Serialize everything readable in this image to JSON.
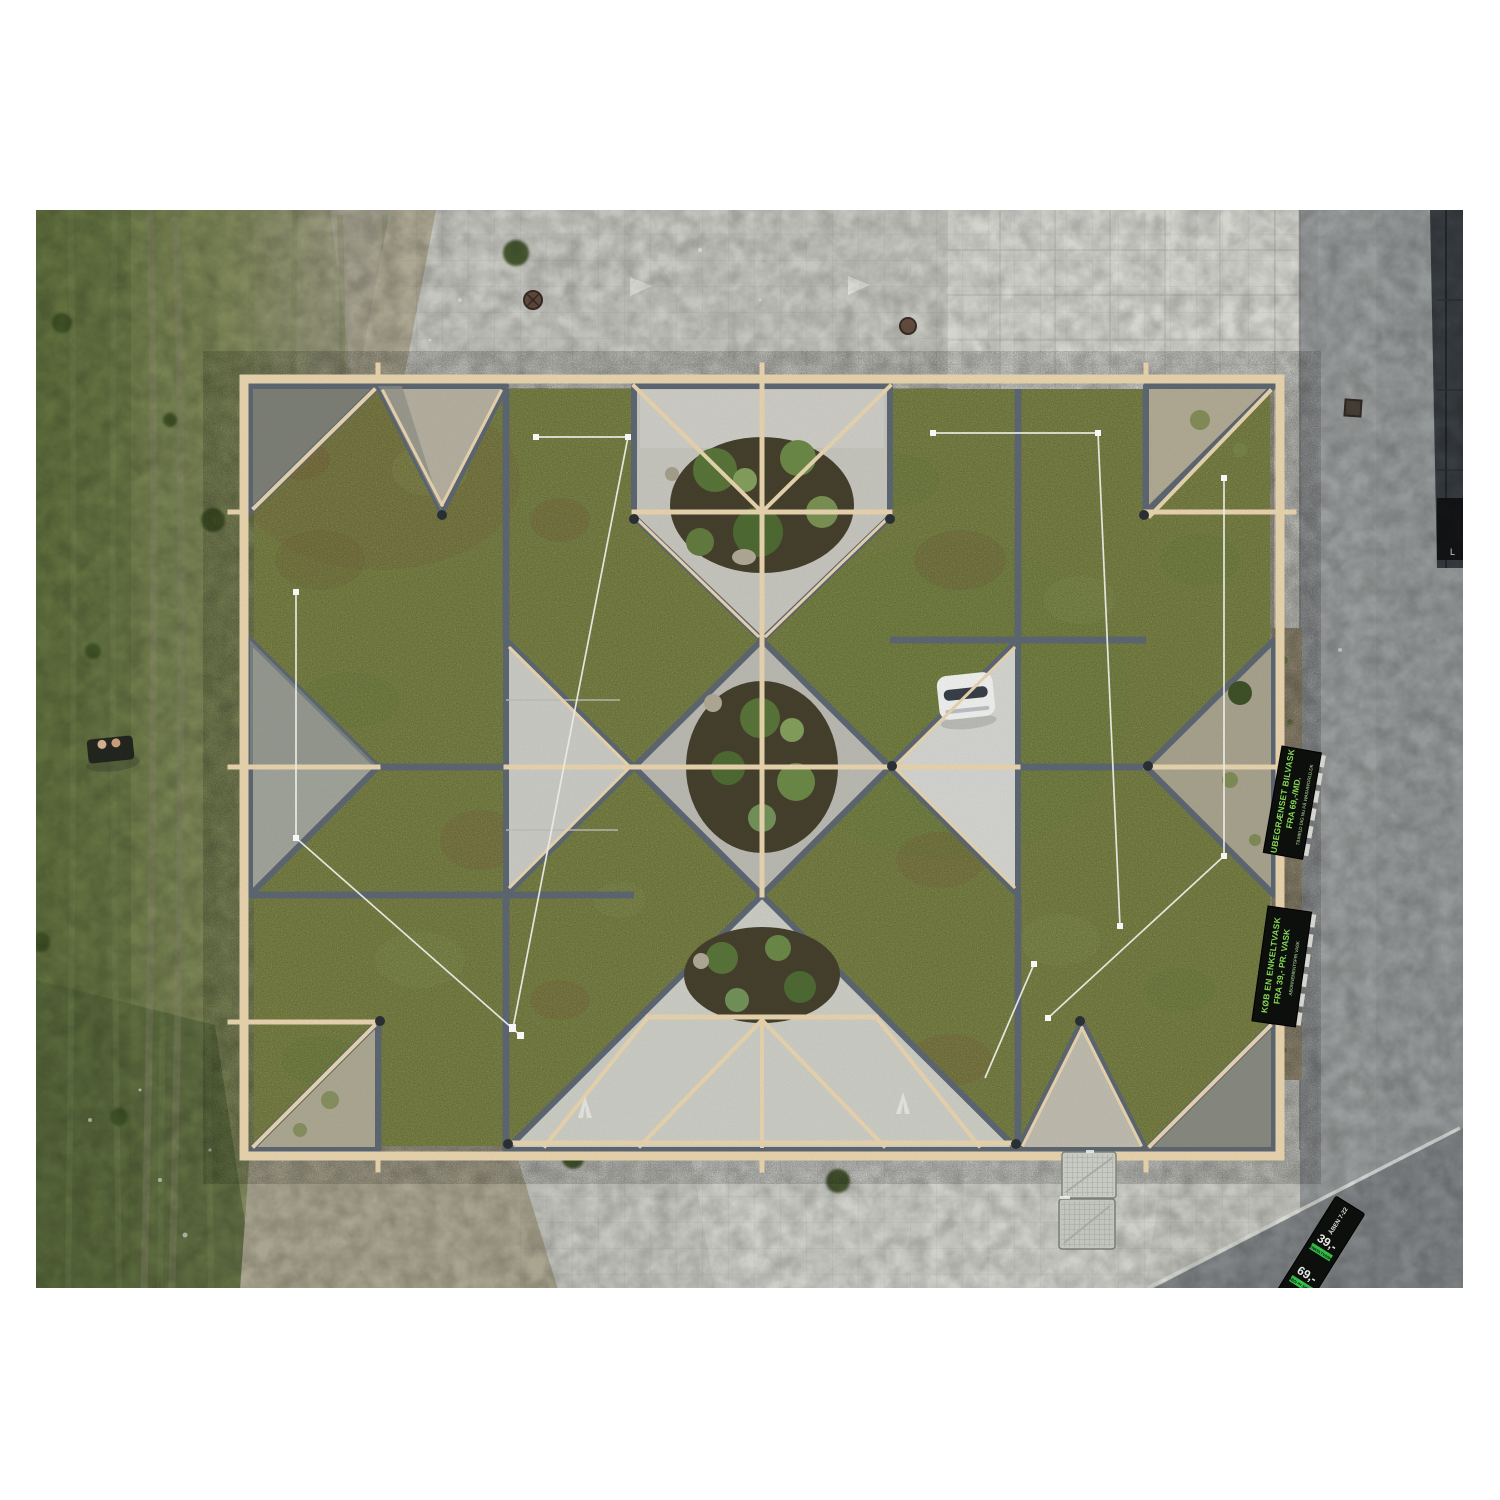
{
  "image": {
    "type": "aerial-drone-photograph",
    "description": "Top-down drone photo of a pavilion with a geometric green sedum roof (arrow and diamond quilt pattern with timber frame and zinc edging), set on a concrete plaza between a worn lawn and an asphalt road, framed by a white border."
  },
  "signs": {
    "roadside_sign_1": {
      "line1": "UBEGRÆNSET BILVASK",
      "line2": "FRA 69,-/MD.",
      "line3": "TILMELD DIG NU PÅ WASHWORLD.DK"
    },
    "roadside_sign_2": {
      "line1": "KØB EN ENKELTVASK",
      "line2": "FRA 39,- PR. VASK",
      "line3": "ABONNEMENTSFRI VASK"
    },
    "pylon_sign": {
      "open_hours": "ÅBEN 7-22",
      "price_single": "39,-",
      "label_single": "ENKELTVASK",
      "price_subscription": "69,-",
      "label_subscription": "ABONNEMENT",
      "brand": "WASHWORLD"
    },
    "facade_panel_mark": "L"
  },
  "colors": {
    "sedum_green": "#87904E",
    "slate_gray": "#5E6873",
    "timber_cream": "#EAD6B0",
    "lawn_green": "#6F7F4A",
    "plaza_concrete": "#CDCEC7",
    "courtyard_concrete": "#C8C7BF",
    "road_asphalt": "#9B9E9F",
    "soil_brown": "#46412D",
    "sign_board_black": "#0D100D",
    "sign_text_green": "#8CE05A",
    "wire_white": "#F4F4EE"
  }
}
